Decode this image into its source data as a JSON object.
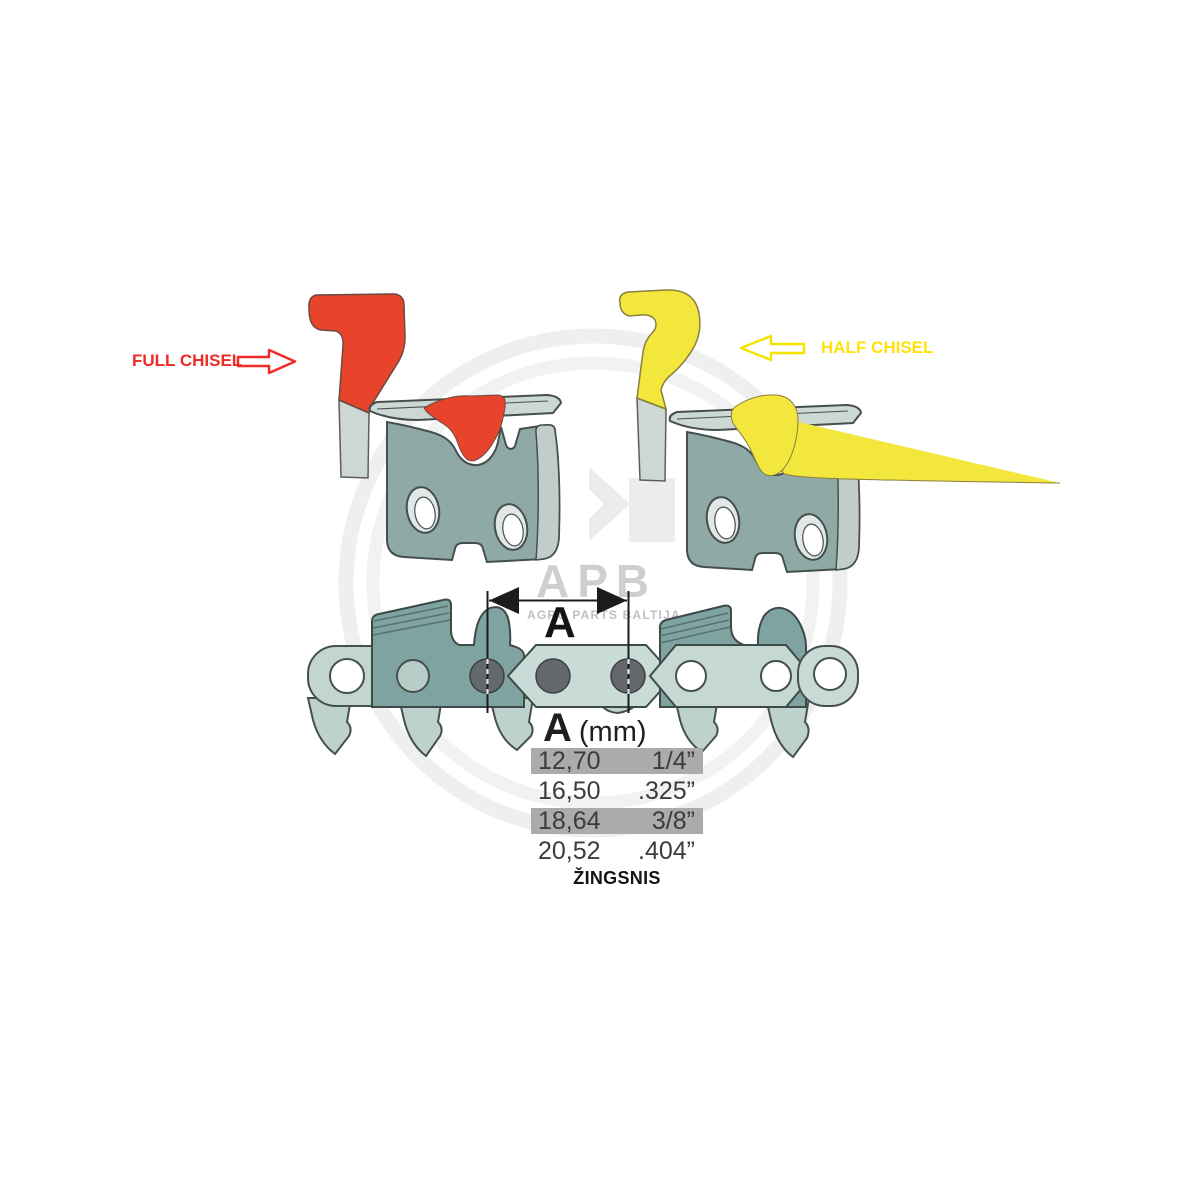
{
  "full_chisel": {
    "label": "FULL CHISEL",
    "color": "#e8432b",
    "label_color": "#ee2b24",
    "arrow_direction": "right"
  },
  "half_chisel": {
    "label": "HALF CHISEL",
    "color": "#f3e73e",
    "label_color": "#ffe20a",
    "arrow_direction": "left"
  },
  "dimension": {
    "label": "A"
  },
  "pitch_table": {
    "header_letter": "A",
    "header_unit": "(mm)",
    "columns": [
      "millimetres",
      "inches"
    ],
    "rows": [
      {
        "mm": "12,70",
        "inch": "1/4”",
        "highlighted": true
      },
      {
        "mm": "16,50",
        "inch": ".325”",
        "highlighted": false
      },
      {
        "mm": "18,64",
        "inch": "3/8”",
        "highlighted": true
      },
      {
        "mm": "20,52",
        "inch": ".404”",
        "highlighted": false
      }
    ],
    "caption": "ŽINGSNIS",
    "highlight_color": "#ababab"
  },
  "watermark": {
    "brand": "APB",
    "subtitle": "AGRO PARTS BALTIJA",
    "ring_color": "#efefef",
    "text_color": "#cfcfcf"
  },
  "colors": {
    "link_body": "#8fa9a6",
    "link_side_face": "#c2cdc9",
    "top_plate": "#cbd8d4",
    "chain_link_light": "#c6d8d4",
    "chain_cutter_dark": "#7fa3a0",
    "rivet_gray": "#65686b",
    "outline": "#3e4a48",
    "steel_shank": "#cdd7d3",
    "dimension_black": "#1c1c1c"
  }
}
